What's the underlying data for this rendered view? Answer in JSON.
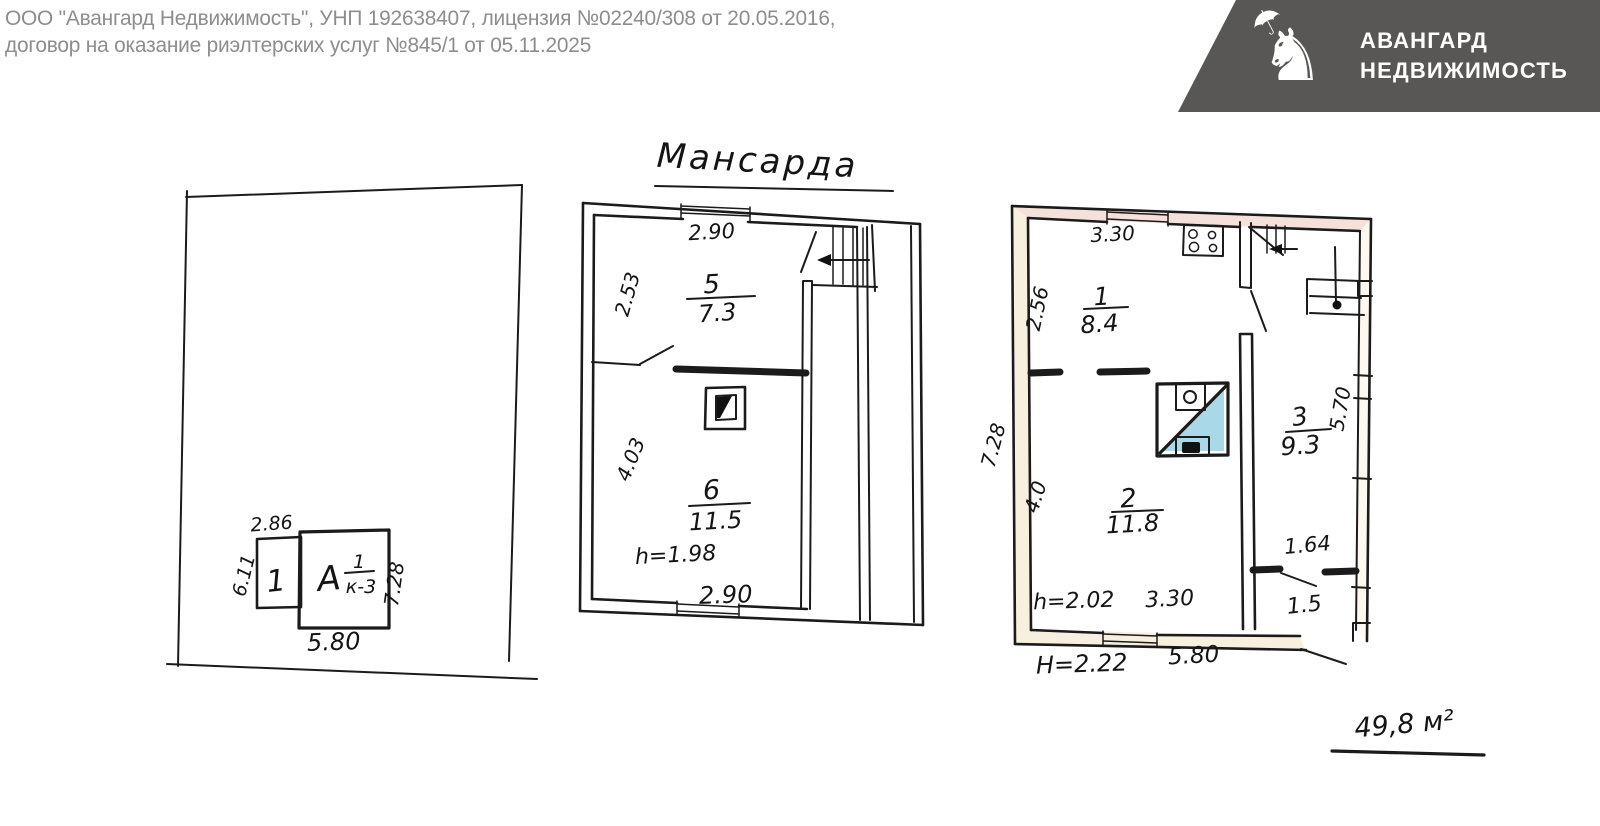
{
  "header": {
    "line1": "ООО \"Авангард Недвижимость\", УНП 192638407, лицензия №02240/308 от 20.05.2016,",
    "line2": "договор на оказание риэлтерских услуг №845/1 от 05.11.2025"
  },
  "logo": {
    "name_line1": "АВАНГАРД",
    "name_line2": "НЕДВИЖИМОСТЬ",
    "icon": "knight-with-umbrella"
  },
  "colors": {
    "logo_bg": "#595755",
    "header_text": "#8d8d8d",
    "ink": "#1b1b1b",
    "furnace_blue": "#a9d8e9",
    "wall_cream": "#f7eeda",
    "wall_pink": "#f3dcd2"
  },
  "site_plan": {
    "building1": {
      "label": "1",
      "dim_top": "2.86",
      "dim_left": "6.11"
    },
    "building2": {
      "letter": "А",
      "frac_top": "1",
      "frac_bottom": "к-3",
      "dim_right": "7.28",
      "dim_bottom": "5.80"
    }
  },
  "attic_plan": {
    "title": "Мансарда",
    "dim_top": "2.90",
    "dim_left_upper": "2.53",
    "dim_left_lower": "4.03",
    "dim_bottom": "2.90",
    "height_note": "h=1.98",
    "room5": {
      "number": "5",
      "area": "7.3"
    },
    "room6": {
      "number": "6",
      "area": "11.5"
    }
  },
  "floor_plan": {
    "dim_top": "3.30",
    "dim_left_room1": "2.56",
    "dim_left_outer": "7.28",
    "dim_left_room2": "4.0",
    "dim_right": "5.70",
    "dim_hall_width": "1.64",
    "hall_area": "1.5",
    "height_note_room": "h=2.02",
    "dim_bottom_inner": "3.30",
    "height_note_outer": "Н=2.22",
    "dim_bottom_outer": "5.80",
    "room1": {
      "number": "1",
      "area": "8.4"
    },
    "room2": {
      "number": "2",
      "area": "11.8"
    },
    "room3": {
      "number": "3",
      "area": "9.3"
    }
  },
  "total_area": "49,8 м²"
}
